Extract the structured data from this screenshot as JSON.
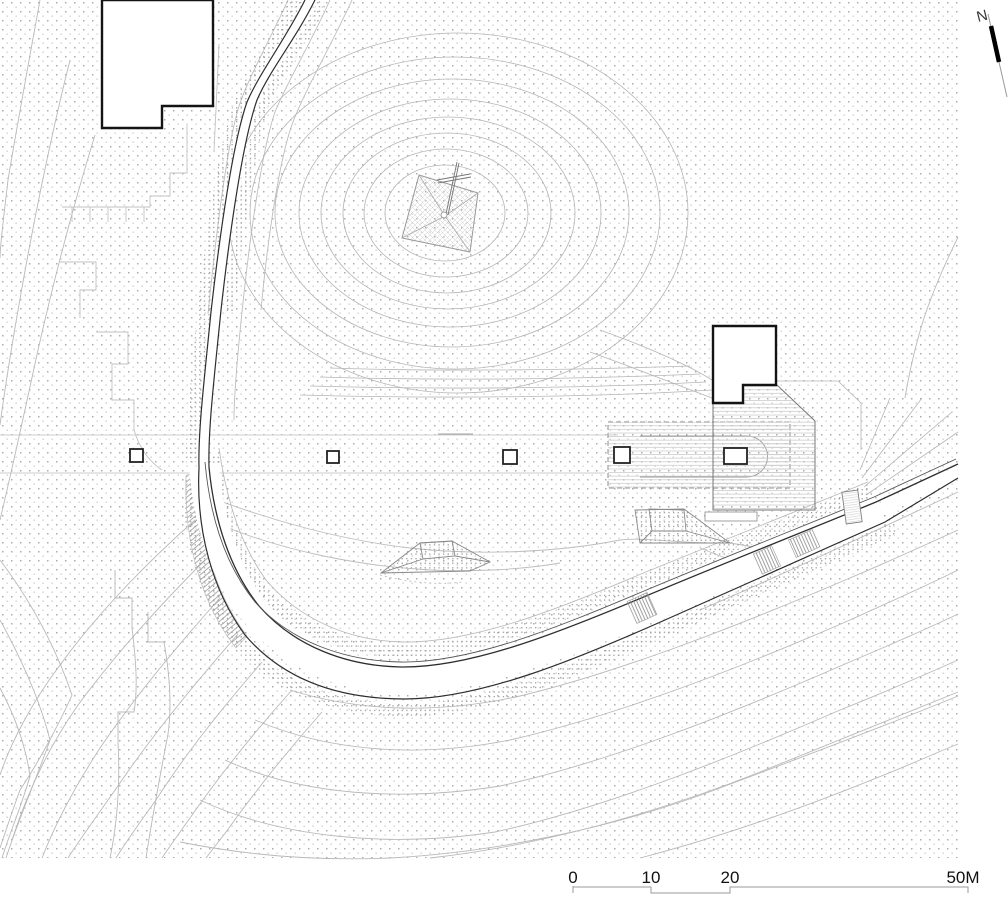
{
  "scalebar": {
    "labels": [
      "0",
      "10",
      "20",
      "50M"
    ]
  },
  "north": {
    "label": "N"
  },
  "palette": {
    "background": "#ffffff",
    "building_outline": "#141414",
    "contour_light": "#b5b5b5",
    "contour_medium": "#8f8f8f",
    "road_edge": "#2e2e2e",
    "hatch": "#c9c9c9",
    "stipple": "#b3b3b3",
    "dashed_outline": "#a8a8a8",
    "text": "#111111"
  }
}
